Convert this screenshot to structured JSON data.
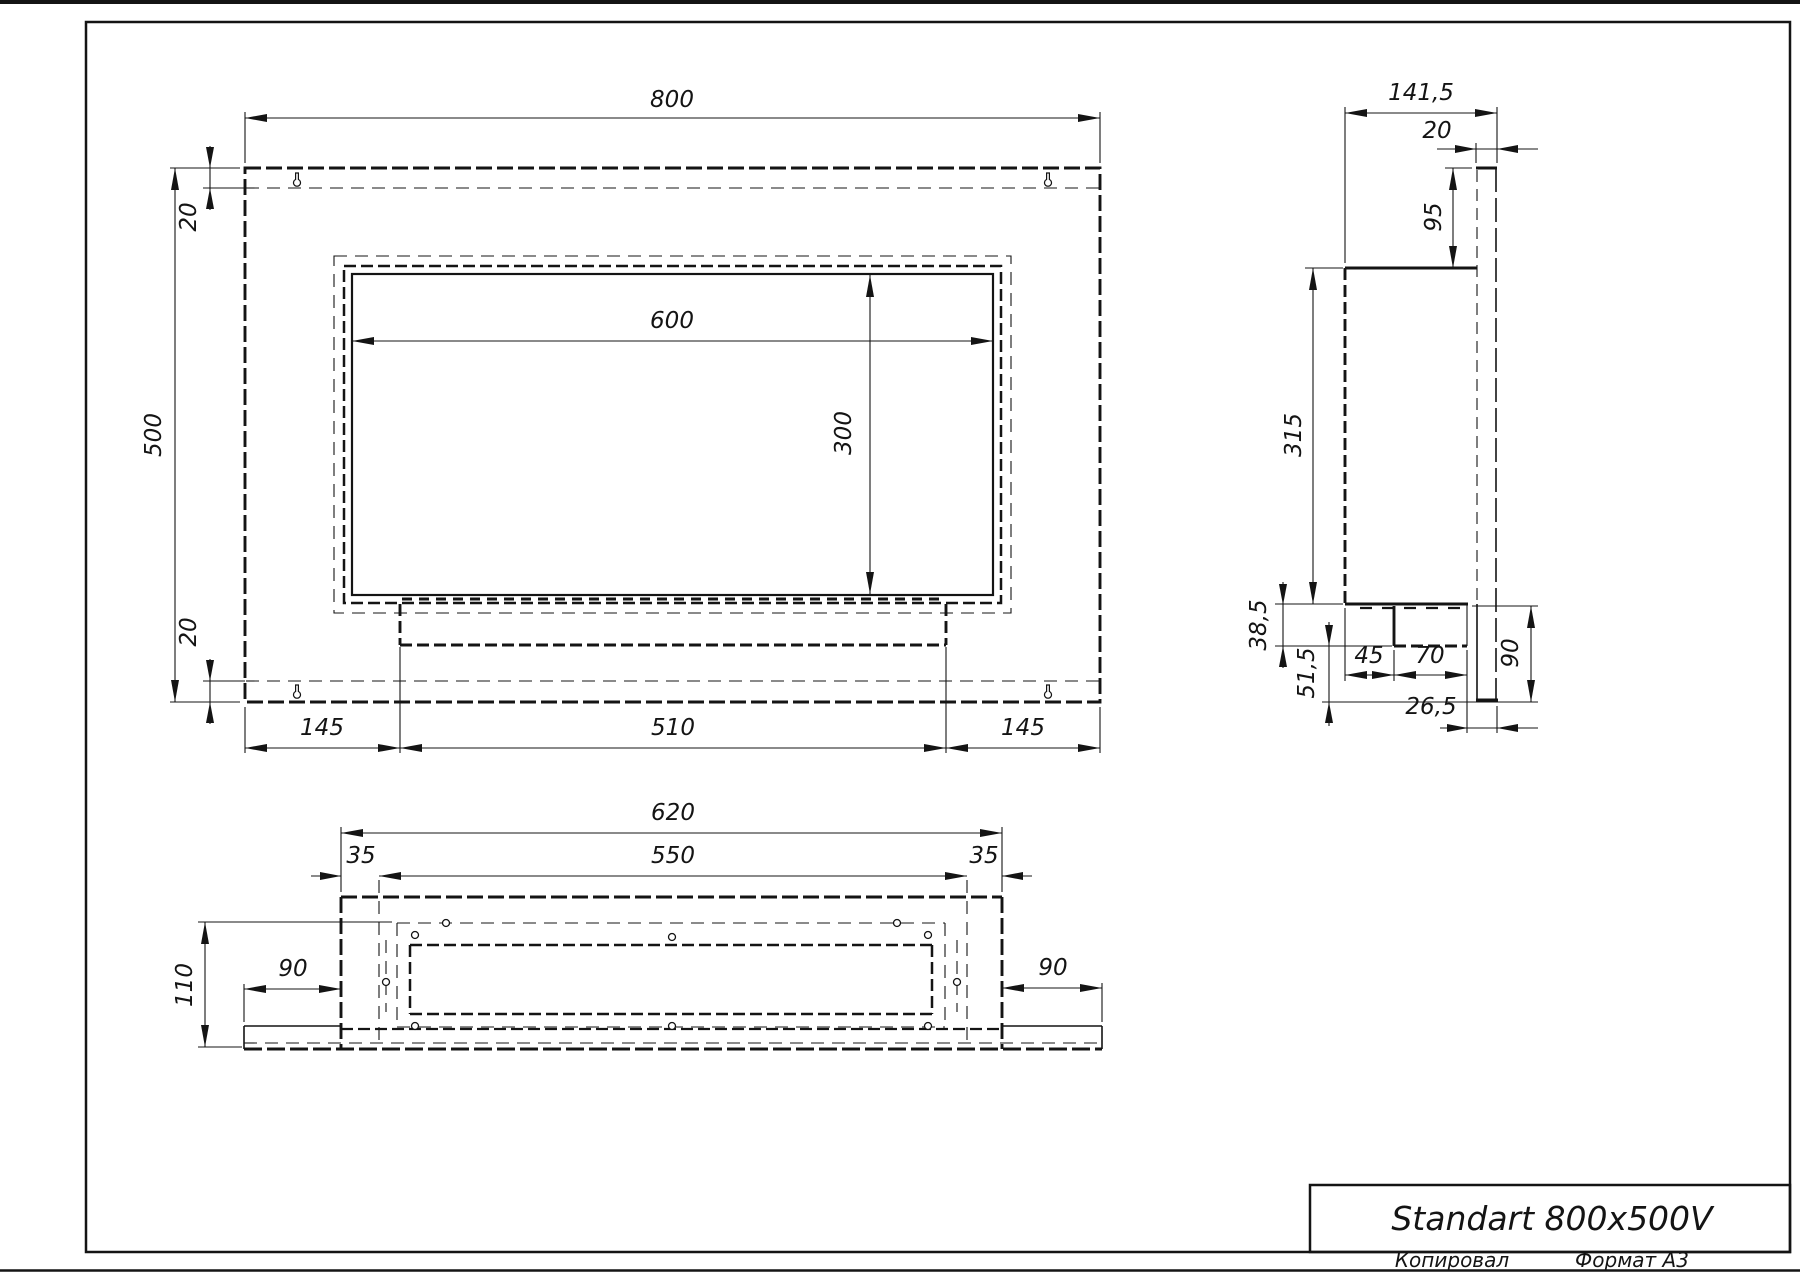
{
  "title_block": {
    "title": "Standart 800x500V",
    "copied_label": "Копировал",
    "format_label": "Формат A3"
  },
  "front_view": {
    "dims": {
      "width": "800",
      "height": "500",
      "offset_top": "20",
      "offset_bottom": "20",
      "opening_width": "600",
      "opening_height": "300",
      "margin_left": "145",
      "burner_width": "510",
      "margin_right": "145"
    }
  },
  "side_view": {
    "dims": {
      "depth": "141,5",
      "back_gap": "20",
      "top_to_box": "95",
      "box_height": "315",
      "tray_height": "38,5",
      "bottom_drop": "51,5",
      "front_to_tray": "45",
      "tray_depth": "70",
      "back_offset": "26,5",
      "bracket_height": "90"
    }
  },
  "bottom_view": {
    "dims": {
      "outer_width": "620",
      "inner_width": "550",
      "margin_left": "35",
      "margin_right": "35",
      "depth": "110",
      "flange_left": "90",
      "flange_right": "90"
    }
  }
}
